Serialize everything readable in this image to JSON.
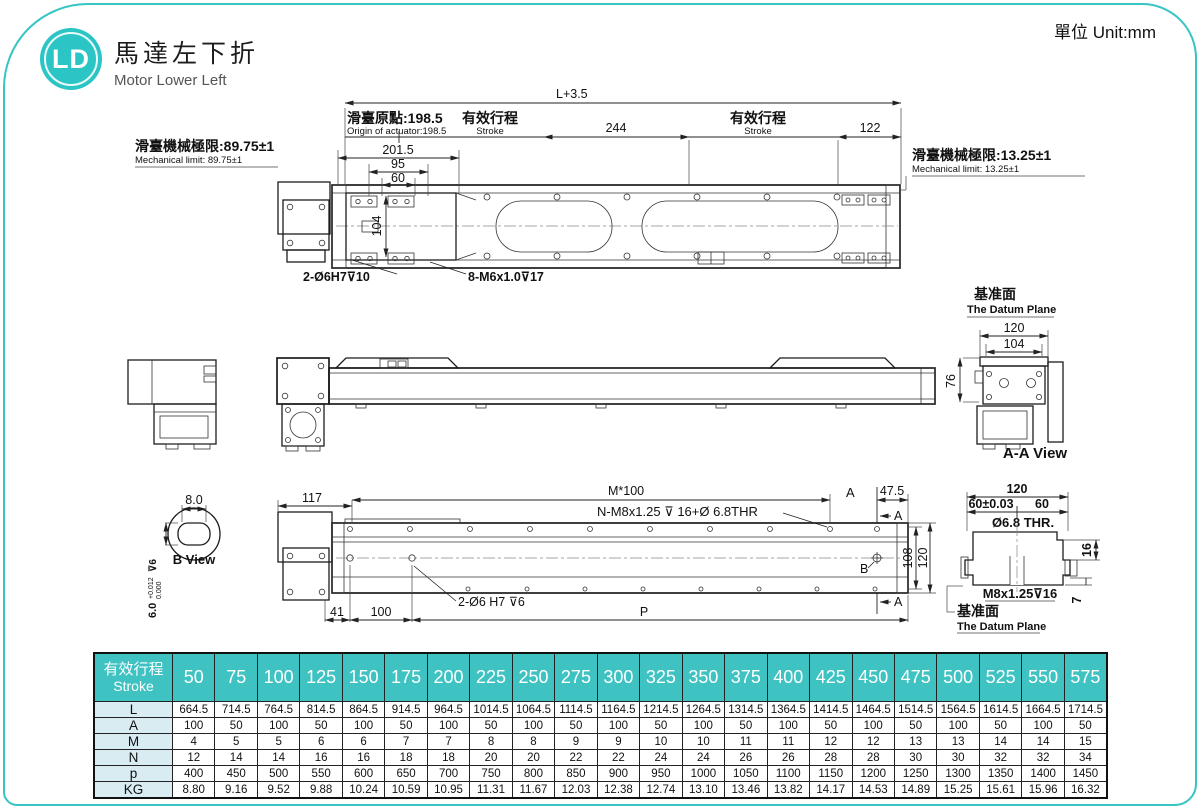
{
  "header": {
    "badge": "LD",
    "title_zh": "馬達左下折",
    "title_en": "Motor Lower Left",
    "unit": "單位 Unit:mm"
  },
  "top_view": {
    "l_dim": "L+3.5",
    "origin_zh": "滑臺原點:198.5",
    "origin_en": "Origin of actuator:198.5",
    "stroke_zh": "有效行程",
    "stroke_en": "Stroke",
    "d244": "244",
    "d122": "122",
    "limit_left_zh": "滑臺機械極限:89.75±1",
    "limit_left_en": "Mechanical limit: 89.75±1",
    "limit_right_zh": "滑臺機械極限:13.25±1",
    "limit_right_en": "Mechanical limit: 13.25±1",
    "d201": "201.5",
    "d95": "95",
    "d60": "60",
    "d104": "104",
    "hole1": "2-Ø6H7⊽10",
    "hole2": "8-M6x1.0⊽17"
  },
  "aa_view": {
    "datum_zh": "基准面",
    "datum_en": "The Datum Plane",
    "d120": "120",
    "d104": "104",
    "d76": "76",
    "label": "A-A View"
  },
  "b_view": {
    "d8": "8.0",
    "label": "B View",
    "tol_base": "6.0",
    "tol_sup": "+0.012",
    "tol_sub": "0.000",
    "tol_depth": "⊽6"
  },
  "bottom_view": {
    "d117": "117",
    "m100": "M*100",
    "thread": "N-M8x1.25 ⊽ 16+Ø 6.8THR",
    "a": "A",
    "d475": "47.5",
    "d108": "108",
    "d120": "120",
    "b": "B",
    "d41": "41",
    "d100": "100",
    "dowel": "2-Ø6 H7 ⊽6",
    "p": "P"
  },
  "section_view": {
    "d120": "120",
    "d60t": "60±0.03",
    "d60": "60",
    "thr": "Ø6.8 THR.",
    "m8": "M8x1.25⊽16",
    "d16": "16",
    "d7": "7",
    "datum_zh": "基准面",
    "datum_en": "The Datum Plane"
  },
  "table": {
    "head_zh": "有效行程",
    "head_en": "Stroke",
    "strokes": [
      "50",
      "75",
      "100",
      "125",
      "150",
      "175",
      "200",
      "225",
      "250",
      "275",
      "300",
      "325",
      "350",
      "375",
      "400",
      "425",
      "450",
      "475",
      "500",
      "525",
      "550",
      "575"
    ],
    "rows": [
      {
        "label": "L",
        "values": [
          "664.5",
          "714.5",
          "764.5",
          "814.5",
          "864.5",
          "914.5",
          "964.5",
          "1014.5",
          "1064.5",
          "1114.5",
          "1164.5",
          "1214.5",
          "1264.5",
          "1314.5",
          "1364.5",
          "1414.5",
          "1464.5",
          "1514.5",
          "1564.5",
          "1614.5",
          "1664.5",
          "1714.5"
        ]
      },
      {
        "label": "A",
        "values": [
          "100",
          "50",
          "100",
          "50",
          "100",
          "50",
          "100",
          "50",
          "100",
          "50",
          "100",
          "50",
          "100",
          "50",
          "100",
          "50",
          "100",
          "50",
          "100",
          "50",
          "100",
          "50"
        ]
      },
      {
        "label": "M",
        "values": [
          "4",
          "5",
          "5",
          "6",
          "6",
          "7",
          "7",
          "8",
          "8",
          "9",
          "9",
          "10",
          "10",
          "11",
          "11",
          "12",
          "12",
          "13",
          "13",
          "14",
          "14",
          "15"
        ]
      },
      {
        "label": "N",
        "values": [
          "12",
          "14",
          "14",
          "16",
          "16",
          "18",
          "18",
          "20",
          "20",
          "22",
          "22",
          "24",
          "24",
          "26",
          "26",
          "28",
          "28",
          "30",
          "30",
          "32",
          "32",
          "34"
        ]
      },
      {
        "label": "p",
        "values": [
          "400",
          "450",
          "500",
          "550",
          "600",
          "650",
          "700",
          "750",
          "800",
          "850",
          "900",
          "950",
          "1000",
          "1050",
          "1100",
          "1150",
          "1200",
          "1250",
          "1300",
          "1350",
          "1400",
          "1450"
        ]
      },
      {
        "label": "KG",
        "values": [
          "8.80",
          "9.16",
          "9.52",
          "9.88",
          "10.24",
          "10.59",
          "10.95",
          "11.31",
          "11.67",
          "12.03",
          "12.38",
          "12.74",
          "13.10",
          "13.46",
          "13.82",
          "14.17",
          "14.53",
          "14.89",
          "15.25",
          "15.61",
          "15.96",
          "16.32"
        ]
      }
    ]
  },
  "colors": {
    "accent": "#36c4c4",
    "table_header": "#3fc2c2",
    "label_col": "#d8ecf2"
  }
}
